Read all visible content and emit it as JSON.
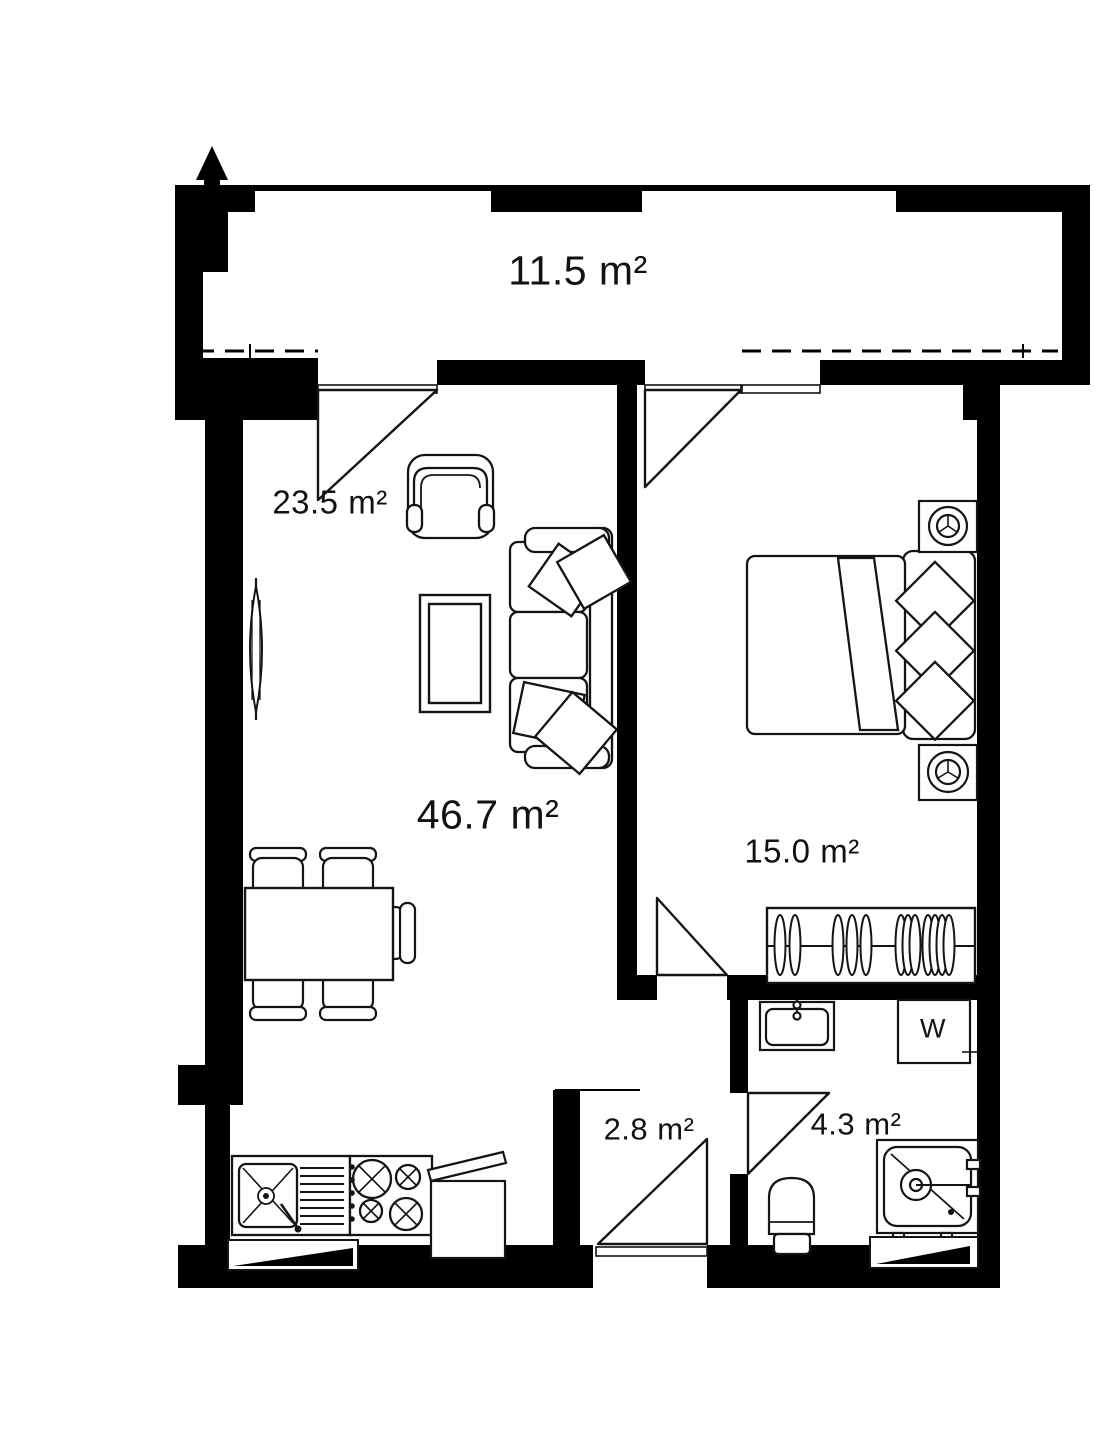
{
  "plan": {
    "type": "apartment-floor-plan",
    "units": "m²",
    "rooms": [
      {
        "id": "balcony",
        "area_label": "11.5 m²"
      },
      {
        "id": "living-zone",
        "area_label": "23.5 m²"
      },
      {
        "id": "living-room",
        "area_label": "46.7 m²"
      },
      {
        "id": "bedroom",
        "area_label": "15.0 m²"
      },
      {
        "id": "hallway",
        "area_label": "2.8 m²"
      },
      {
        "id": "bathroom",
        "area_label": "4.3 m²"
      }
    ],
    "appliances": {
      "washer_label": "W"
    },
    "colors": {
      "wall": "#000000",
      "line": "#141414",
      "background": "#ffffff"
    },
    "icons": [
      "north-arrow-icon",
      "sofa",
      "armchair",
      "coffee-table",
      "radiator",
      "dining-table",
      "dining-chairs",
      "kitchen-sink",
      "stove",
      "kitchen-counter",
      "double-bed",
      "pillows",
      "nightstand-lamp",
      "wardrobe",
      "bathroom-sink",
      "toilet",
      "shower-cabin",
      "washing-machine"
    ]
  }
}
